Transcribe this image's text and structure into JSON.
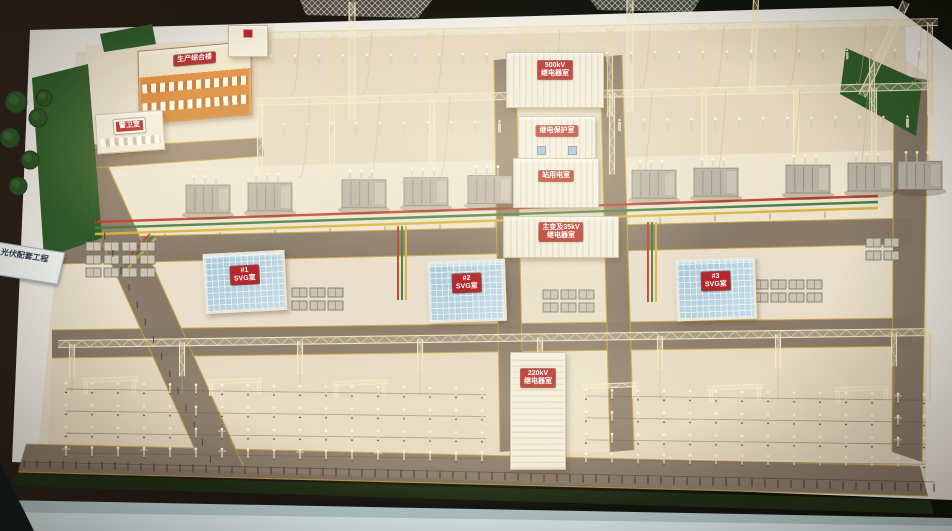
{
  "signs": {
    "base_plate": "光伏配套工程",
    "admin_building": "生产综合楼",
    "guard_room": "警卫室",
    "relay_500kv": {
      "line1": "500kV",
      "line2": "继电器室"
    },
    "protection_room": "继电保护室",
    "station_power": "站用电室",
    "main_transformer_relay": {
      "line1": "主变及35kV",
      "line2": "继电器室"
    },
    "svg_room_1": {
      "line1": "#1",
      "line2": "SVG室"
    },
    "svg_room_2": {
      "line1": "#2",
      "line2": "SVG室"
    },
    "svg_room_3": {
      "line1": "#3",
      "line2": "SVG室"
    },
    "relay_220kv": {
      "line1": "220kV",
      "line2": "继电器室"
    }
  },
  "colors": {
    "sign_red": "#b5272a",
    "sign_text": "#ffffff",
    "phase_red": "#c23b2e",
    "phase_green": "#3d7a3f",
    "phase_yellow": "#d9b23a",
    "grass_green": "#2f5c2a",
    "platform": "#e9decb",
    "road": "#847666",
    "road_line_yellow": "#c9a23e",
    "structure_warm_white": "#f5e9c4",
    "svg_roof_blue": "#bdd7e3",
    "orange_building": "#e08a3e",
    "table_edge_blue": "#e3f0f2"
  }
}
